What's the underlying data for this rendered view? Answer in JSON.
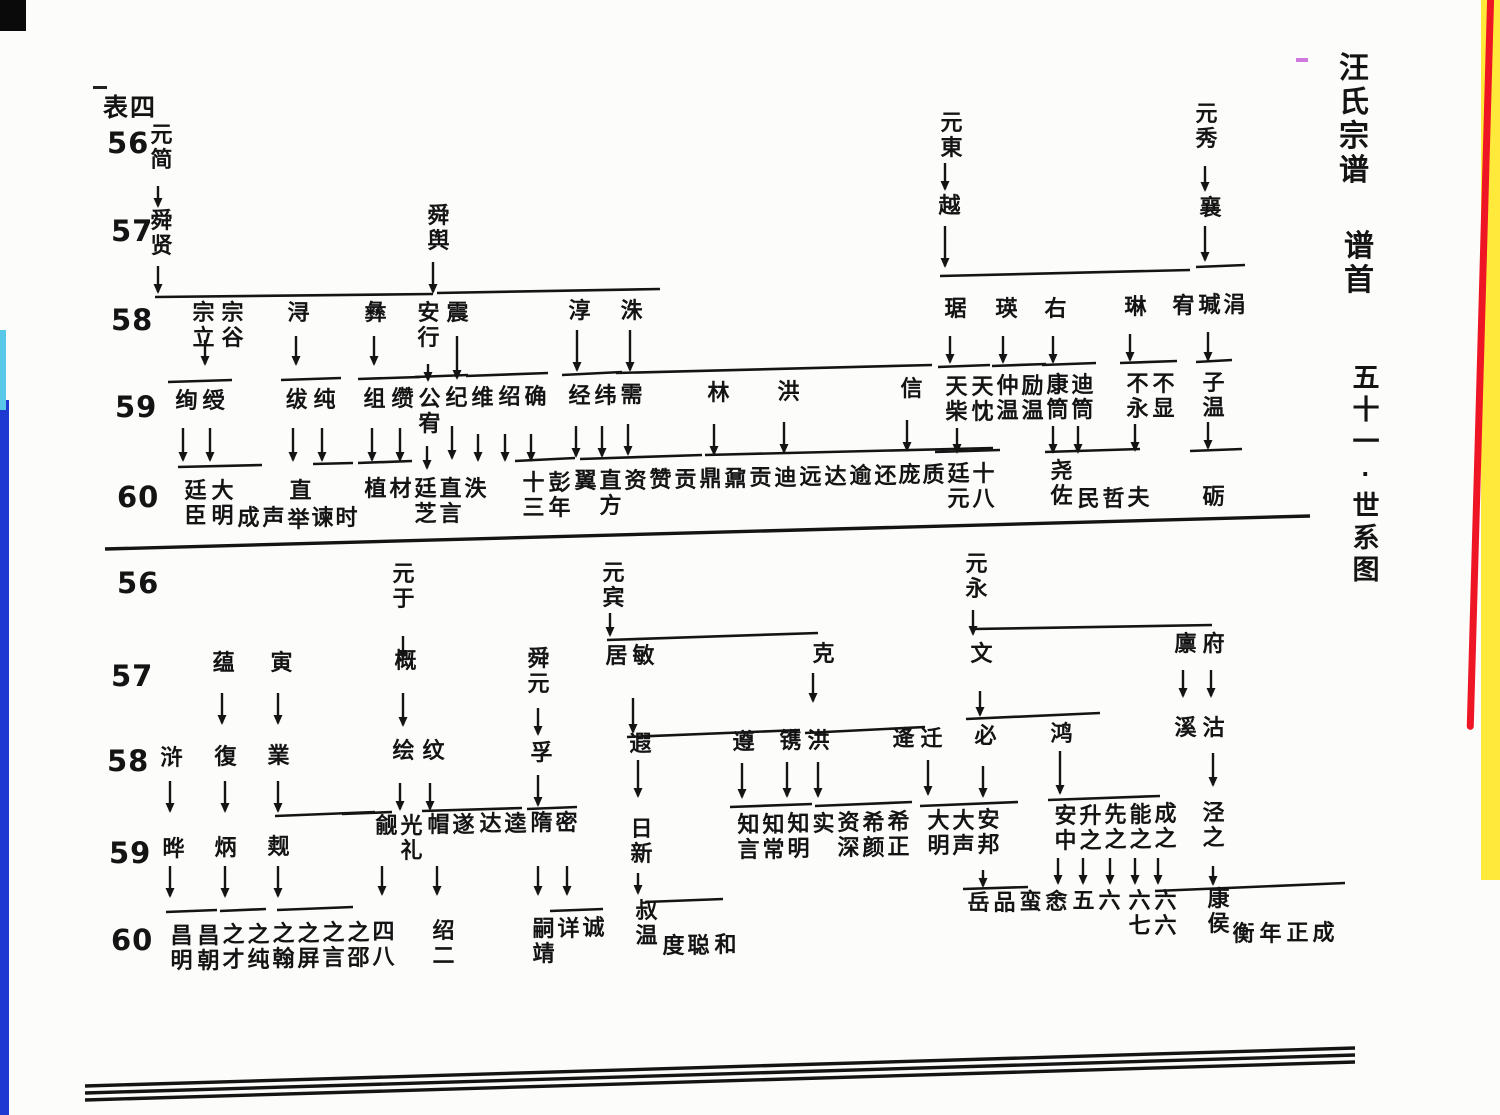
{
  "page": {
    "corner_label": "表四",
    "side_titles": [
      {
        "text": "汪氏宗谱",
        "x": 1336,
        "y": 52,
        "size": 30,
        "line": 34
      },
      {
        "text": "谱首",
        "x": 1341,
        "y": 230,
        "size": 30,
        "line": 34
      },
      {
        "text": "五十一·世系图",
        "x": 1348,
        "y": 362,
        "size": 27,
        "line": 32
      }
    ]
  },
  "diagram": {
    "generation_labels": [
      {
        "t": "56",
        "x": 107,
        "y": 126
      },
      {
        "t": "57",
        "x": 111,
        "y": 214
      },
      {
        "t": "58",
        "x": 111,
        "y": 303
      },
      {
        "t": "59",
        "x": 115,
        "y": 390
      },
      {
        "t": "60",
        "x": 117,
        "y": 480
      },
      {
        "t": "56",
        "x": 117,
        "y": 566
      },
      {
        "t": "57",
        "x": 111,
        "y": 659
      },
      {
        "t": "58",
        "x": 107,
        "y": 744
      },
      {
        "t": "59",
        "x": 109,
        "y": 836
      },
      {
        "t": "60",
        "x": 111,
        "y": 923
      }
    ],
    "nodes": [
      [
        "元简",
        148,
        122
      ],
      [
        "舜贤",
        148,
        208
      ],
      [
        "舜舆",
        425,
        203
      ],
      [
        "元東",
        938,
        110
      ],
      [
        "越",
        936,
        193
      ],
      [
        "元秀",
        1193,
        101
      ],
      [
        "襄",
        1197,
        195
      ],
      [
        "宗立",
        190,
        300
      ],
      [
        "宗谷",
        219,
        300
      ],
      [
        "浔",
        285,
        300
      ],
      [
        "彝",
        362,
        300
      ],
      [
        "安行",
        415,
        300
      ],
      [
        "震",
        444,
        300
      ],
      [
        "淳",
        566,
        298
      ],
      [
        "洙",
        618,
        298
      ],
      [
        "琚",
        942,
        296
      ],
      [
        "瑛",
        993,
        296
      ],
      [
        "右",
        1042,
        296
      ],
      [
        "琳",
        1122,
        294
      ],
      [
        "宥",
        1170,
        293
      ],
      [
        "瑊",
        1196,
        292
      ],
      [
        "涓",
        1221,
        292
      ],
      [
        "绚",
        173,
        388
      ],
      [
        "绶",
        200,
        388
      ],
      [
        "绂",
        283,
        387
      ],
      [
        "纯",
        311,
        387
      ],
      [
        "组",
        361,
        386
      ],
      [
        "缵",
        389,
        386
      ],
      [
        "公宥",
        416,
        386
      ],
      [
        "纪",
        443,
        385
      ],
      [
        "维",
        469,
        385
      ],
      [
        "绍",
        496,
        384
      ],
      [
        "确",
        522,
        384
      ],
      [
        "经",
        566,
        383
      ],
      [
        "纬",
        592,
        383
      ],
      [
        "需",
        618,
        382
      ],
      [
        "林",
        705,
        380
      ],
      [
        "洪",
        775,
        379
      ],
      [
        "信",
        898,
        376
      ],
      [
        "天柴",
        943,
        374
      ],
      [
        "天忱",
        969,
        374
      ],
      [
        "仲温",
        994,
        373
      ],
      [
        "励温",
        1019,
        373
      ],
      [
        "康筒",
        1044,
        372
      ],
      [
        "迪筒",
        1069,
        372
      ],
      [
        "不永",
        1124,
        371
      ],
      [
        "不显",
        1150,
        371
      ],
      [
        "子温",
        1200,
        370
      ],
      [
        "廷臣",
        182,
        478
      ],
      [
        "大明",
        209,
        478
      ],
      [
        "成",
        235,
        505
      ],
      [
        "声",
        260,
        505
      ],
      [
        "直",
        287,
        478
      ],
      [
        "举",
        285,
        507
      ],
      [
        "谏",
        309,
        505
      ],
      [
        "时",
        333,
        505
      ],
      [
        "植",
        362,
        476
      ],
      [
        "材",
        387,
        476
      ],
      [
        "廷芝",
        412,
        476
      ],
      [
        "直言",
        437,
        476
      ],
      [
        "泆",
        462,
        476
      ],
      [
        "十三",
        520,
        470
      ],
      [
        "彭年",
        546,
        470
      ],
      [
        "翼",
        572,
        468
      ],
      [
        "直方",
        597,
        468
      ],
      [
        "资",
        622,
        468
      ],
      [
        "赞",
        647,
        467
      ],
      [
        "贡",
        672,
        467
      ],
      [
        "鼎",
        697,
        466
      ],
      [
        "鼐",
        722,
        466
      ],
      [
        "贡",
        747,
        465
      ],
      [
        "迪",
        772,
        465
      ],
      [
        "远",
        797,
        464
      ],
      [
        "达",
        822,
        464
      ],
      [
        "逾",
        847,
        463
      ],
      [
        "还",
        872,
        463
      ],
      [
        "庞",
        896,
        462
      ],
      [
        "质",
        920,
        462
      ],
      [
        "廷元",
        945,
        461
      ],
      [
        "十八",
        970,
        461
      ],
      [
        "尧佐",
        1048,
        458
      ],
      [
        "民",
        1075,
        486
      ],
      [
        "哲",
        1100,
        486
      ],
      [
        "夫",
        1125,
        485
      ],
      [
        "砺",
        1200,
        484
      ],
      [
        "元于",
        390,
        561
      ],
      [
        "元宾",
        600,
        560
      ],
      [
        "元永",
        963,
        551
      ],
      [
        "蕴",
        210,
        650
      ],
      [
        "寅",
        268,
        650
      ],
      [
        "概",
        392,
        648
      ],
      [
        "舜元",
        525,
        646
      ],
      [
        "居",
        603,
        643
      ],
      [
        "敏",
        630,
        643
      ],
      [
        "克",
        810,
        641
      ],
      [
        "文",
        968,
        641
      ],
      [
        "廪",
        1172,
        631
      ],
      [
        "府",
        1200,
        631
      ],
      [
        "浒",
        158,
        745
      ],
      [
        "復",
        212,
        744
      ],
      [
        "業",
        265,
        743
      ],
      [
        "绘",
        390,
        738
      ],
      [
        "纹",
        420,
        738
      ],
      [
        "孚",
        528,
        740
      ],
      [
        "遐",
        627,
        731
      ],
      [
        "遵",
        730,
        729
      ],
      [
        "镌",
        777,
        728
      ],
      [
        "洪",
        805,
        728
      ],
      [
        "逄",
        890,
        726
      ],
      [
        "迁",
        918,
        726
      ],
      [
        "必",
        972,
        723
      ],
      [
        "鸿",
        1048,
        721
      ],
      [
        "溪",
        1172,
        715
      ],
      [
        "沽",
        1200,
        715
      ],
      [
        "晔",
        160,
        836
      ],
      [
        "炳",
        212,
        835
      ],
      [
        "觌",
        265,
        834
      ],
      [
        "觎",
        373,
        813
      ],
      [
        "光礼",
        398,
        813
      ],
      [
        "帽",
        425,
        812
      ],
      [
        "遂",
        450,
        812
      ],
      [
        "达",
        477,
        811
      ],
      [
        "逵",
        502,
        811
      ],
      [
        "隋",
        528,
        810
      ],
      [
        "密",
        553,
        810
      ],
      [
        "日新",
        628,
        816
      ],
      [
        "知言",
        735,
        812
      ],
      [
        "知常",
        760,
        812
      ],
      [
        "知明",
        785,
        811
      ],
      [
        "实",
        810,
        811
      ],
      [
        "资深",
        835,
        810
      ],
      [
        "希颜",
        860,
        810
      ],
      [
        "希正",
        885,
        809
      ],
      [
        "大明",
        925,
        808
      ],
      [
        "大声",
        950,
        808
      ],
      [
        "安邦",
        975,
        807
      ],
      [
        "安中",
        1052,
        803
      ],
      [
        "升之",
        1077,
        803
      ],
      [
        "先之",
        1102,
        802
      ],
      [
        "能之",
        1127,
        802
      ],
      [
        "成之",
        1152,
        801
      ],
      [
        "泾之",
        1200,
        800
      ],
      [
        "昌明",
        168,
        923
      ],
      [
        "昌朝",
        195,
        923
      ],
      [
        "之才",
        220,
        922
      ],
      [
        "之纯",
        245,
        922
      ],
      [
        "之翰",
        270,
        921
      ],
      [
        "之屏",
        295,
        921
      ],
      [
        "之言",
        320,
        920
      ],
      [
        "之邵",
        345,
        920
      ],
      [
        "四八",
        370,
        919
      ],
      [
        "绍二",
        430,
        918
      ],
      [
        "嗣靖",
        530,
        916
      ],
      [
        "详",
        555,
        916
      ],
      [
        "诚",
        580,
        915
      ],
      [
        "叔温",
        633,
        898
      ],
      [
        "度",
        660,
        933
      ],
      [
        "聪",
        685,
        933
      ],
      [
        "和",
        712,
        932
      ],
      [
        "岳",
        965,
        890
      ],
      [
        "品",
        991,
        890
      ],
      [
        "蛮",
        1017,
        889
      ],
      [
        "悆",
        1043,
        889
      ],
      [
        "五",
        1070,
        888
      ],
      [
        "六",
        1096,
        888
      ],
      [
        "六七",
        1126,
        888
      ],
      [
        "六六",
        1152,
        888
      ],
      [
        "康侯",
        1205,
        886
      ],
      [
        "衡",
        1230,
        921
      ],
      [
        "年",
        1257,
        921
      ],
      [
        "正",
        1284,
        920
      ],
      [
        "成",
        1310,
        920
      ]
    ],
    "arrows": [
      [
        158,
        186,
        20
      ],
      [
        158,
        266,
        26
      ],
      [
        433,
        262,
        30
      ],
      [
        945,
        163,
        26
      ],
      [
        945,
        226,
        40
      ],
      [
        1205,
        166,
        24
      ],
      [
        1205,
        226,
        34
      ],
      [
        205,
        340,
        24
      ],
      [
        296,
        336,
        28
      ],
      [
        374,
        336,
        28
      ],
      [
        428,
        364,
        16
      ],
      [
        457,
        336,
        42
      ],
      [
        577,
        330,
        40
      ],
      [
        630,
        330,
        40
      ],
      [
        950,
        336,
        26
      ],
      [
        1003,
        336,
        26
      ],
      [
        1053,
        336,
        26
      ],
      [
        1130,
        334,
        26
      ],
      [
        1208,
        332,
        28
      ],
      [
        183,
        428,
        32
      ],
      [
        210,
        428,
        32
      ],
      [
        293,
        428,
        32
      ],
      [
        322,
        428,
        32
      ],
      [
        372,
        428,
        32
      ],
      [
        400,
        428,
        32
      ],
      [
        427,
        446,
        22
      ],
      [
        452,
        426,
        32
      ],
      [
        478,
        434,
        26
      ],
      [
        505,
        434,
        26
      ],
      [
        531,
        434,
        26
      ],
      [
        576,
        426,
        30
      ],
      [
        602,
        426,
        30
      ],
      [
        628,
        424,
        30
      ],
      [
        714,
        424,
        30
      ],
      [
        784,
        422,
        30
      ],
      [
        907,
        420,
        30
      ],
      [
        957,
        428,
        24
      ],
      [
        1053,
        426,
        26
      ],
      [
        1078,
        426,
        26
      ],
      [
        1135,
        424,
        26
      ],
      [
        1208,
        422,
        26
      ],
      [
        403,
        636,
        22
      ],
      [
        222,
        693,
        30
      ],
      [
        278,
        693,
        30
      ],
      [
        403,
        693,
        32
      ],
      [
        610,
        613,
        22
      ],
      [
        538,
        708,
        26
      ],
      [
        633,
        698,
        34
      ],
      [
        813,
        673,
        28
      ],
      [
        980,
        691,
        24
      ],
      [
        973,
        610,
        24
      ],
      [
        1183,
        670,
        26
      ],
      [
        1211,
        670,
        26
      ],
      [
        170,
        781,
        30
      ],
      [
        225,
        781,
        30
      ],
      [
        278,
        781,
        30
      ],
      [
        400,
        783,
        26
      ],
      [
        430,
        783,
        26
      ],
      [
        538,
        775,
        30
      ],
      [
        638,
        760,
        36
      ],
      [
        742,
        763,
        34
      ],
      [
        787,
        762,
        34
      ],
      [
        818,
        762,
        34
      ],
      [
        928,
        760,
        34
      ],
      [
        983,
        766,
        30
      ],
      [
        1060,
        751,
        42
      ],
      [
        1213,
        753,
        32
      ],
      [
        170,
        866,
        30
      ],
      [
        225,
        866,
        30
      ],
      [
        278,
        866,
        30
      ],
      [
        382,
        866,
        28
      ],
      [
        437,
        866,
        28
      ],
      [
        538,
        866,
        28
      ],
      [
        567,
        866,
        28
      ],
      [
        638,
        873,
        20
      ],
      [
        983,
        870,
        16
      ],
      [
        1058,
        858,
        25
      ],
      [
        1083,
        858,
        25
      ],
      [
        1110,
        858,
        25
      ],
      [
        1135,
        858,
        25
      ],
      [
        1158,
        858,
        25
      ],
      [
        1213,
        866,
        18
      ]
    ],
    "lines": [
      [
        155,
        297,
        433,
        294
      ],
      [
        437,
        293,
        660,
        289
      ],
      [
        940,
        276,
        1190,
        270
      ],
      [
        1196,
        267,
        1245,
        265
      ],
      [
        168,
        382,
        232,
        380
      ],
      [
        281,
        380,
        341,
        378
      ],
      [
        358,
        379,
        420,
        377
      ],
      [
        415,
        377,
        468,
        375
      ],
      [
        466,
        376,
        548,
        373
      ],
      [
        562,
        375,
        622,
        372
      ],
      [
        616,
        373,
        932,
        365
      ],
      [
        938,
        367,
        990,
        365
      ],
      [
        992,
        366,
        1046,
        364
      ],
      [
        1042,
        365,
        1096,
        363
      ],
      [
        1120,
        363,
        1177,
        361
      ],
      [
        1196,
        362,
        1232,
        360
      ],
      [
        178,
        467,
        262,
        465
      ],
      [
        313,
        464,
        353,
        463
      ],
      [
        358,
        463,
        412,
        461
      ],
      [
        515,
        461,
        575,
        458
      ],
      [
        580,
        459,
        702,
        455
      ],
      [
        705,
        455,
        993,
        448
      ],
      [
        935,
        452,
        1000,
        450
      ],
      [
        1045,
        452,
        1140,
        449
      ],
      [
        1190,
        451,
        1242,
        449
      ],
      [
        105,
        549,
        1310,
        516,
        3.4
      ],
      [
        607,
        640,
        818,
        633
      ],
      [
        973,
        629,
        1212,
        625
      ],
      [
        627,
        737,
        800,
        730
      ],
      [
        805,
        733,
        925,
        727
      ],
      [
        966,
        719,
        1100,
        713
      ],
      [
        275,
        816,
        375,
        812
      ],
      [
        342,
        814,
        392,
        812
      ],
      [
        422,
        811,
        522,
        808
      ],
      [
        527,
        809,
        577,
        807
      ],
      [
        730,
        807,
        812,
        804
      ],
      [
        815,
        806,
        912,
        802
      ],
      [
        920,
        806,
        1018,
        802
      ],
      [
        1048,
        800,
        1160,
        796
      ],
      [
        166,
        912,
        217,
        910
      ],
      [
        220,
        911,
        266,
        909
      ],
      [
        277,
        910,
        353,
        907
      ],
      [
        550,
        911,
        603,
        909
      ],
      [
        645,
        902,
        723,
        899
      ],
      [
        963,
        889,
        1028,
        887
      ],
      [
        1155,
        891,
        1345,
        883
      ],
      [
        85,
        1086,
        1355,
        1048,
        3.4
      ],
      [
        85,
        1093,
        1355,
        1055,
        3.4
      ],
      [
        85,
        1100,
        1355,
        1062,
        3.4
      ]
    ]
  },
  "decor": {
    "ink_color": "#141414",
    "paper_color": "#fcfcfa",
    "left_strip_color": "#1d39d2",
    "right_strip_yellow": "#ffe93a",
    "right_strip_red": "#ee1525"
  }
}
